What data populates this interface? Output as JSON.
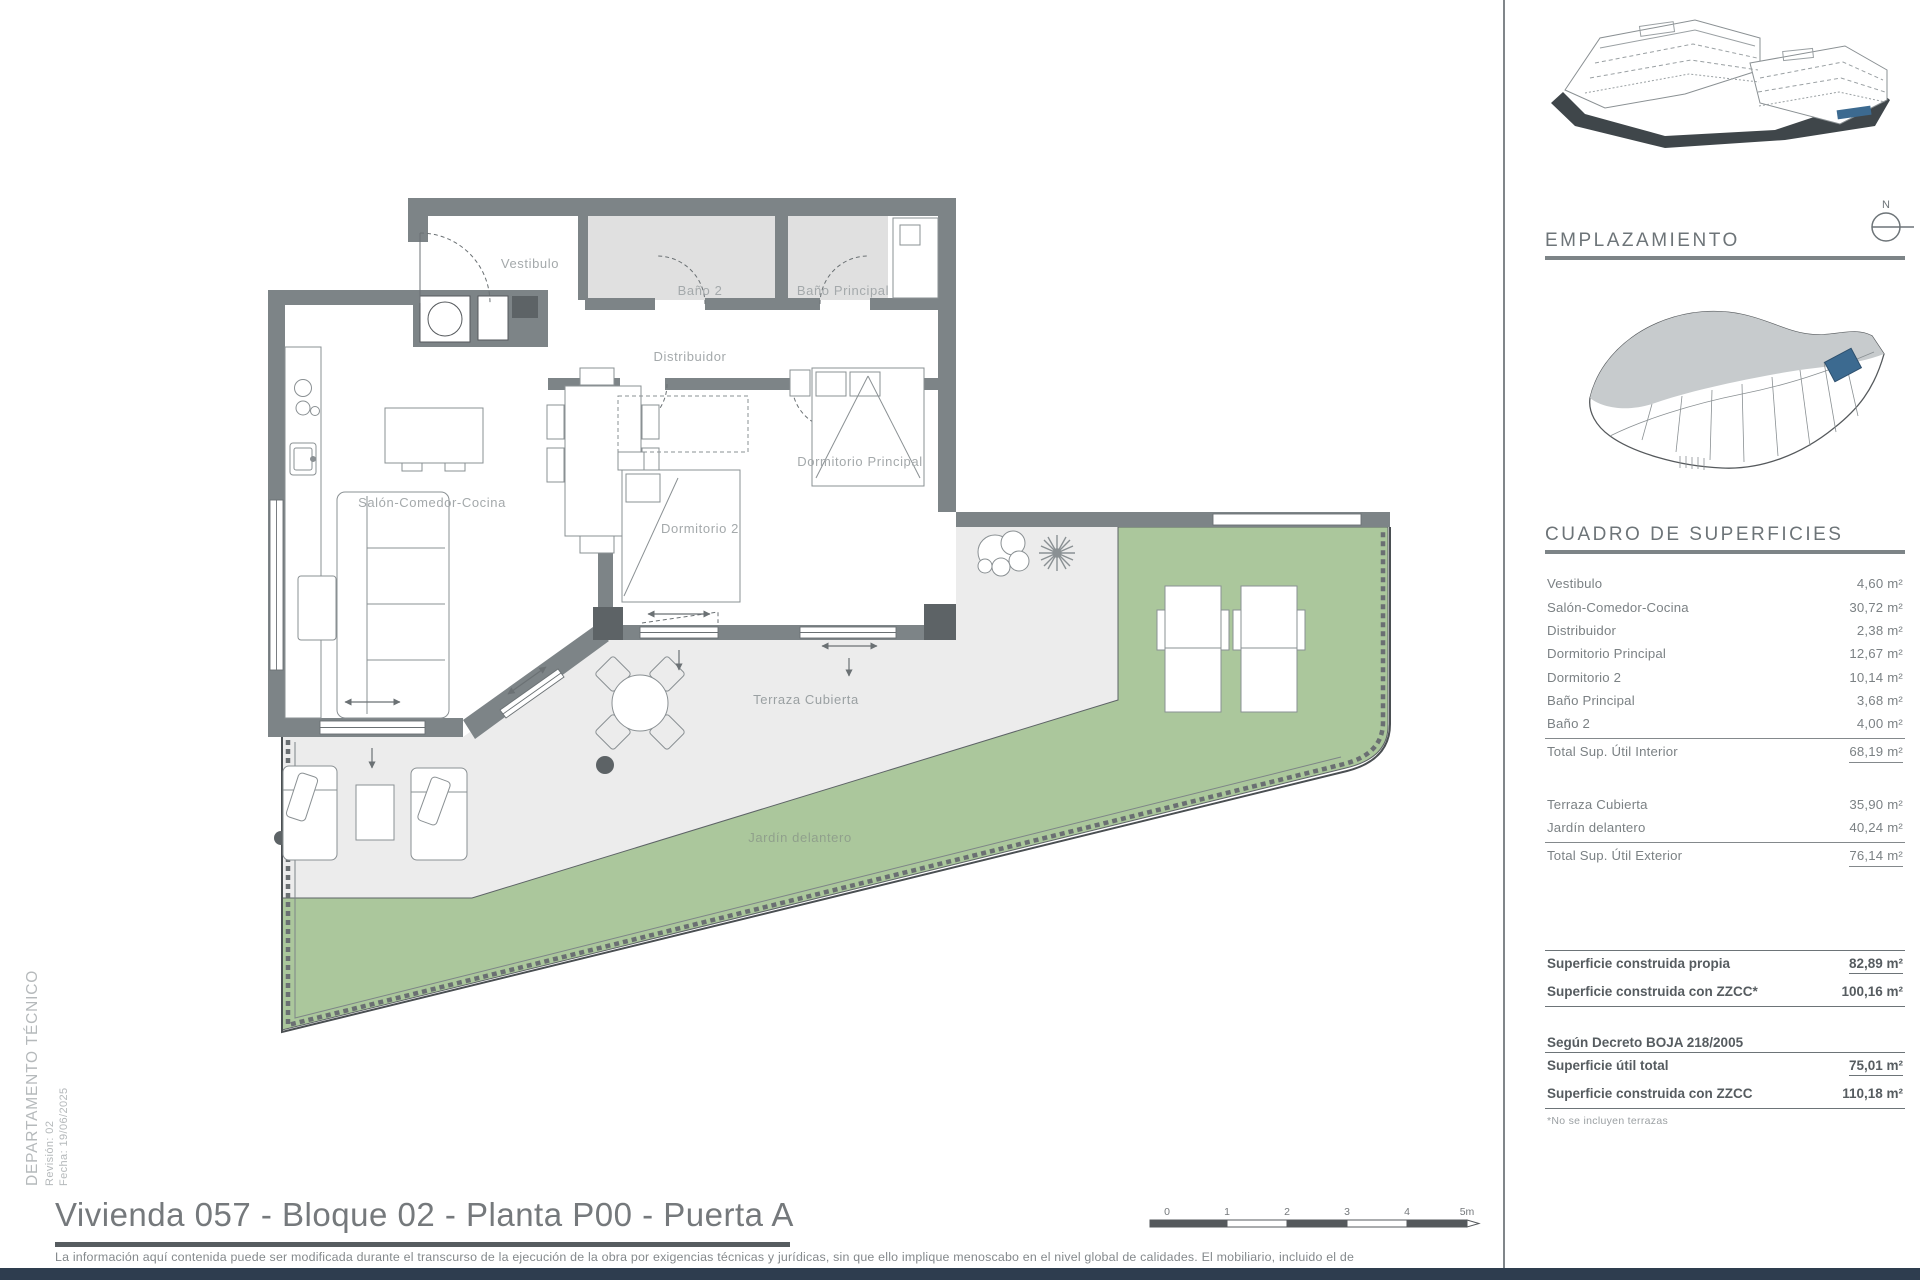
{
  "plan": {
    "labels": {
      "vestibulo": "Vestibulo",
      "bano2": "Baño 2",
      "bano_principal": "Baño Principal",
      "distribuidor": "Distribuidor",
      "salon": "Salón-Comedor-Cocina",
      "dormitorio2": "Dormitorio 2",
      "dormitorio_principal": "Dormitorio Principal",
      "terraza": "Terraza Cubierta",
      "jardin": "Jardín delantero"
    },
    "colors": {
      "wall": "#7d8487",
      "wall_dark": "#5d6366",
      "terrace": "#ececec",
      "garden": "#abc79c",
      "bath_floor": "#e0e0e0",
      "accent_unit": "#3c6a90",
      "navy_bar": "#2e3d4f"
    }
  },
  "sidebar": {
    "emplazamiento_title": "EMPLAZAMIENTO",
    "north_label": "N",
    "cuadro_title": "CUADRO DE SUPERFICIES",
    "interior_rows": [
      {
        "label": "Vestibulo",
        "value": "4,60 m²"
      },
      {
        "label": "Salón-Comedor-Cocina",
        "value": "30,72 m²"
      },
      {
        "label": "Distribuidor",
        "value": "2,38 m²"
      },
      {
        "label": "Dormitorio Principal",
        "value": "12,67 m²"
      },
      {
        "label": "Dormitorio 2",
        "value": "10,14 m²"
      },
      {
        "label": "Baño Principal",
        "value": "3,68 m²"
      },
      {
        "label": "Baño 2",
        "value": "4,00 m²"
      }
    ],
    "total_interior": {
      "label": "Total Sup. Útil Interior",
      "value": "68,19 m²"
    },
    "exterior_rows": [
      {
        "label": "Terraza Cubierta",
        "value": "35,90 m²"
      },
      {
        "label": "Jardín delantero",
        "value": "40,24 m²"
      }
    ],
    "total_exterior": {
      "label": "Total Sup. Útil Exterior",
      "value": "76,14 m²"
    },
    "summary_rows": [
      {
        "label": "Superficie construida propia",
        "value": "82,89 m²"
      },
      {
        "label": "Superficie construida con ZZCC*",
        "value": "100,16 m²"
      }
    ],
    "decreto_heading": "Según Decreto BOJA 218/2005",
    "decreto_rows": [
      {
        "label": "Superficie útil total",
        "value": "75,01 m²"
      },
      {
        "label": "Superficie construida con ZZCC",
        "value": "110,18 m²"
      }
    ],
    "footnote": "*No se incluyen terrazas"
  },
  "footer": {
    "title": "Vivienda 057 - Bloque 02 - Planta P00 - Puerta A",
    "scale_labels": [
      "0",
      "1",
      "2",
      "3",
      "4",
      "5m"
    ],
    "disclaimer_line1": "La información aquí contenida puede  ser modificada durante el transcurso de la ejecución de la obra por exigencias técnicas y jurídicas,  sin  que  ello  implique  menoscabo  en  el nivel global de calidades.  El  mobiliario, incluido el de",
    "disclaimer_line2": "cocina, se refleja a efectos meramente decorativos, sin que se incluya en la oferta. Los peldaños de acceso a la vivienda y  salidas  a patios,  puede alterarse  en función de la rasante de las calles y corresponde a  la  D.F.  fijar el criterio."
  },
  "side_text": {
    "department": "DEPARTAMENTO TÉCNICO",
    "revision": "Revisión: 02",
    "date": "Fecha: 19/06/2025"
  }
}
